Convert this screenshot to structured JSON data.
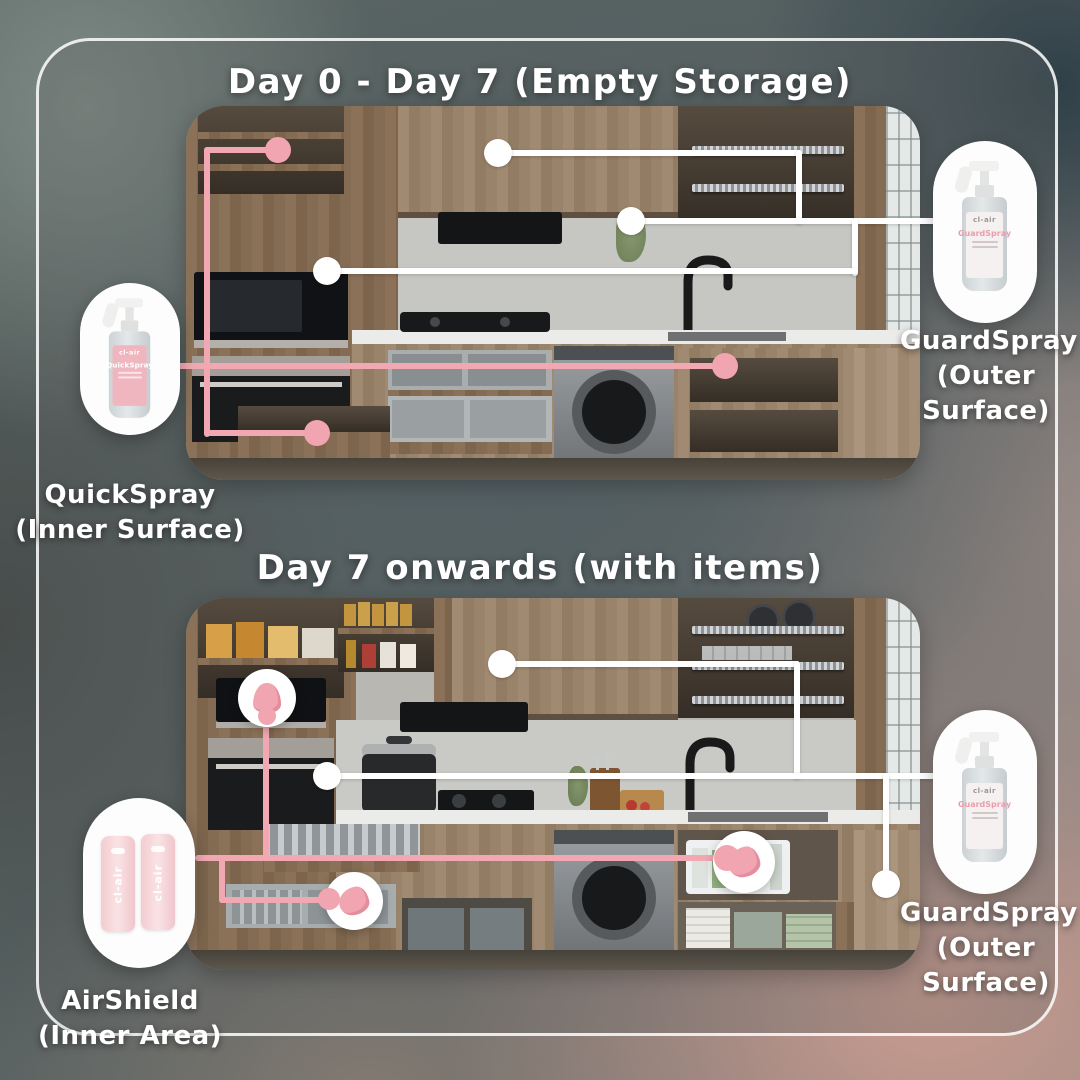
{
  "colors": {
    "pink_accent": "#F1A8B3",
    "line_white": "#FFFFFF",
    "wood": "#937C64"
  },
  "section_empty": {
    "title": "Day 0 - Day 7 (Empty Storage)",
    "left_product": {
      "brand": "cl-air",
      "name": "QuickSpray",
      "caption_line1": "QuickSpray",
      "caption_line2": "(Inner Surface)"
    },
    "right_product": {
      "brand": "cl-air",
      "name": "GuardSpray",
      "caption_line1": "GuardSpray",
      "caption_line2": "(Outer",
      "caption_line3": "Surface)"
    }
  },
  "section_items": {
    "title": "Day 7 onwards (with items)",
    "left_product": {
      "brand": "cl-air",
      "caption_line1": "AirShield",
      "caption_line2": "(Inner Area)"
    },
    "right_product": {
      "brand": "cl-air",
      "name": "GuardSpray",
      "caption_line1": "GuardSpray",
      "caption_line2": "(Outer",
      "caption_line3": "Surface)"
    }
  }
}
